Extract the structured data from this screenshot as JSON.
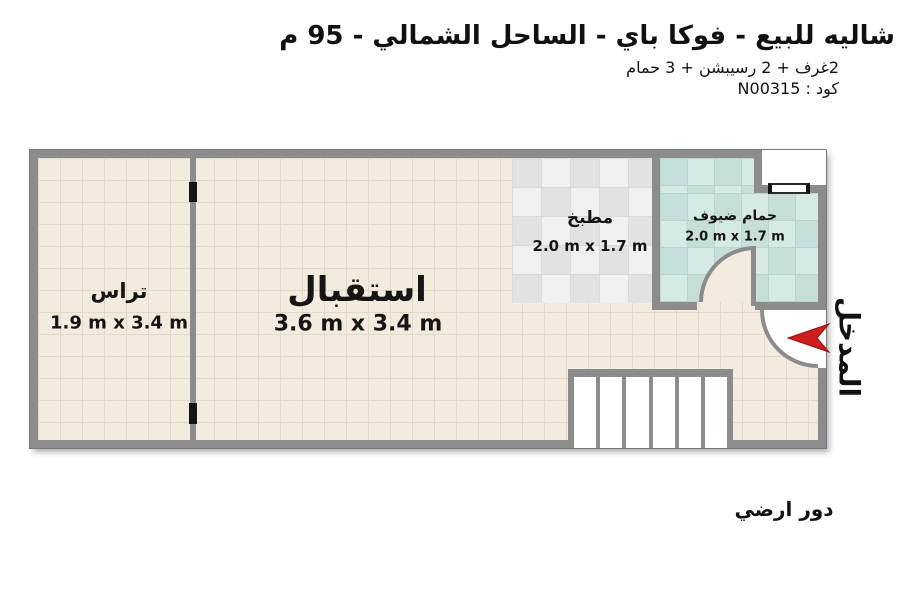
{
  "header": {
    "title": "شاليه للبيع - فوكا باي - الساحل الشمالي - 95 م",
    "subtitle": "2غرف + 2 رسيبشن + 3 حمام",
    "code": "كود : N00315"
  },
  "plan": {
    "rooms": [
      {
        "id": "terrace",
        "name": "تراس",
        "dims": "1.9 m x 3.4 m"
      },
      {
        "id": "reception",
        "name": "استقبال",
        "dims": "3.6 m x 3.4 m"
      },
      {
        "id": "kitchen",
        "name": "مطبخ",
        "dims": "2.0 m x 1.7 m"
      },
      {
        "id": "guest-bathroom",
        "name": "حمام ضيوف",
        "dims": "2.0 m x 1.7 m"
      }
    ],
    "entrance_label": "المدخل",
    "floor_label": "دور ارضي",
    "stairs_steps": 6
  },
  "colors": {
    "wall": "#8c8c8c",
    "floor": "#f2ebde",
    "kitchen_floor": "#e9e9eb",
    "bathroom_floor": "#cde3df",
    "entrance_arrow": "#ce1e1e",
    "text": "#111111"
  }
}
